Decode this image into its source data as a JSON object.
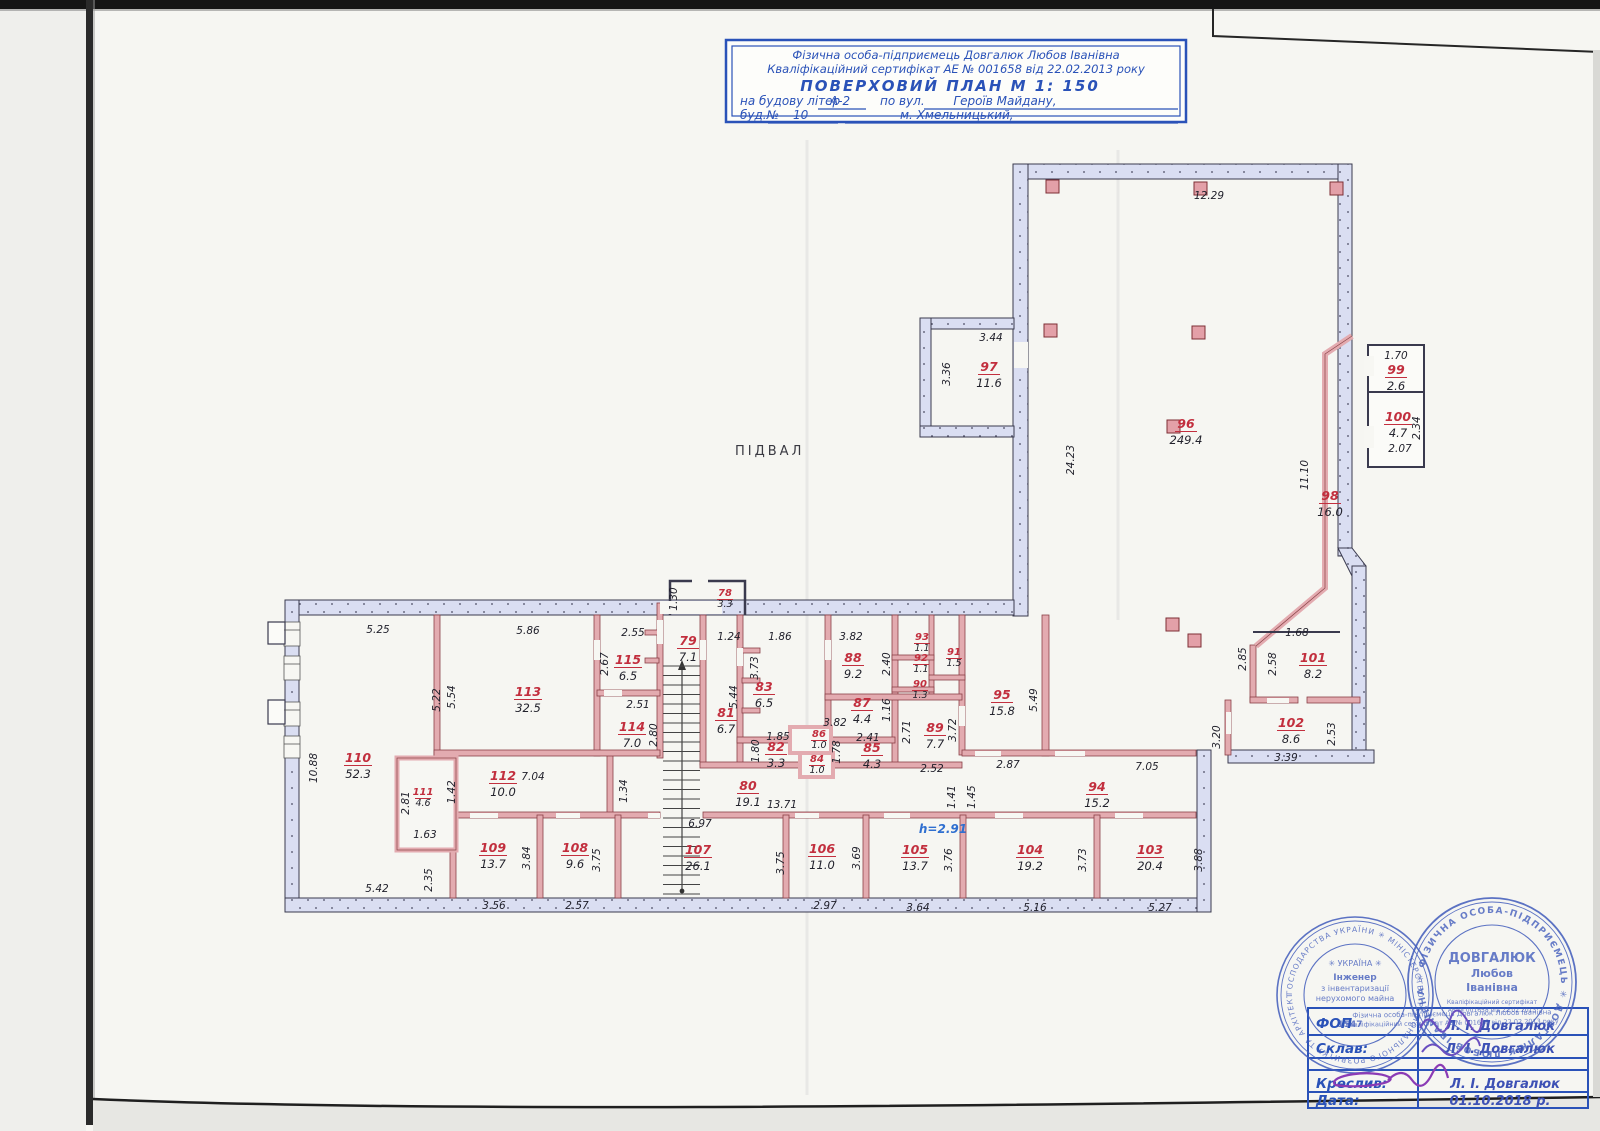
{
  "title_block": {
    "line1": "Фізична особа-підприємець Довгалюк Любов Іванівна",
    "line2": "Кваліфікаційний сертифікат АЕ № 001658 від 22.02.2013 року",
    "line3": "ПОВЕРХОВИЙ  ПЛАН      М 1: 150",
    "line4_prefix": "на будову літер",
    "line4_litera": "А-2",
    "line4_via": "по вул.",
    "line4_street": "Героїв Майдану,",
    "line5_prefix": "буд.№",
    "line5_number": "10",
    "line5_city": "м. Хмельницький,"
  },
  "plan": {
    "floor_label": "ПІДВАЛ",
    "height_note": "h=2.91",
    "rooms": [
      {
        "n": "78",
        "a": "3.3",
        "x": 725,
        "y": 596,
        "s": 1
      },
      {
        "n": "79",
        "a": "7.1",
        "x": 688,
        "y": 645
      },
      {
        "n": "80",
        "a": "19.1",
        "x": 748,
        "y": 790
      },
      {
        "n": "81",
        "a": "6.7",
        "x": 726,
        "y": 717
      },
      {
        "n": "82",
        "a": "3.3",
        "x": 776,
        "y": 751
      },
      {
        "n": "83",
        "a": "6.5",
        "x": 764,
        "y": 691
      },
      {
        "n": "84",
        "a": "1.0",
        "x": 817,
        "y": 762,
        "s": 1
      },
      {
        "n": "85",
        "a": "4.3",
        "x": 872,
        "y": 752
      },
      {
        "n": "86",
        "a": "1.0",
        "x": 819,
        "y": 737,
        "s": 1
      },
      {
        "n": "87",
        "a": "4.4",
        "x": 862,
        "y": 707
      },
      {
        "n": "88",
        "a": "9.2",
        "x": 853,
        "y": 662
      },
      {
        "n": "89",
        "a": "7.7",
        "x": 935,
        "y": 732
      },
      {
        "n": "90",
        "a": "1.3",
        "x": 920,
        "y": 687,
        "s": 1
      },
      {
        "n": "91",
        "a": "1.5",
        "x": 954,
        "y": 655,
        "s": 1
      },
      {
        "n": "92",
        "a": "1.1",
        "x": 921,
        "y": 661,
        "s": 1
      },
      {
        "n": "93",
        "a": "1.1",
        "x": 922,
        "y": 640,
        "s": 1
      },
      {
        "n": "94",
        "a": "15.2",
        "x": 1097,
        "y": 791
      },
      {
        "n": "95",
        "a": "15.8",
        "x": 1002,
        "y": 699
      },
      {
        "n": "96",
        "a": "249.4",
        "x": 1186,
        "y": 428
      },
      {
        "n": "97",
        "a": "11.6",
        "x": 989,
        "y": 371
      },
      {
        "n": "98",
        "a": "16.0",
        "x": 1330,
        "y": 500
      },
      {
        "n": "99",
        "a": "2.6",
        "x": 1396,
        "y": 374
      },
      {
        "n": "100",
        "a": "4.7",
        "x": 1398,
        "y": 421
      },
      {
        "n": "101",
        "a": "8.2",
        "x": 1313,
        "y": 662
      },
      {
        "n": "102",
        "a": "8.6",
        "x": 1291,
        "y": 727
      },
      {
        "n": "103",
        "a": "20.4",
        "x": 1150,
        "y": 854
      },
      {
        "n": "104",
        "a": "19.2",
        "x": 1030,
        "y": 854
      },
      {
        "n": "105",
        "a": "13.7",
        "x": 915,
        "y": 854
      },
      {
        "n": "106",
        "a": "11.0",
        "x": 822,
        "y": 853
      },
      {
        "n": "107",
        "a": "26.1",
        "x": 698,
        "y": 854
      },
      {
        "n": "108",
        "a": "9.6",
        "x": 575,
        "y": 852
      },
      {
        "n": "109",
        "a": "13.7",
        "x": 493,
        "y": 852
      },
      {
        "n": "110",
        "a": "52.3",
        "x": 358,
        "y": 762
      },
      {
        "n": "111",
        "a": "4.6",
        "x": 423,
        "y": 795,
        "s": 1
      },
      {
        "n": "112",
        "a": "10.0",
        "x": 503,
        "y": 780
      },
      {
        "n": "113",
        "a": "32.5",
        "x": 528,
        "y": 696
      },
      {
        "n": "114",
        "a": "7.0",
        "x": 632,
        "y": 731
      },
      {
        "n": "115",
        "a": "6.5",
        "x": 628,
        "y": 664
      }
    ],
    "dims": [
      {
        "t": "12.29",
        "x": 1209,
        "y": 199
      },
      {
        "t": "3.44",
        "x": 991,
        "y": 341
      },
      {
        "t": "3.36",
        "x": 950,
        "y": 374,
        "r": 1
      },
      {
        "t": "24.23",
        "x": 1074,
        "y": 460,
        "r": 1
      },
      {
        "t": "11.10",
        "x": 1308,
        "y": 475,
        "r": 1
      },
      {
        "t": "1.70",
        "x": 1396,
        "y": 359
      },
      {
        "t": "2.34",
        "x": 1420,
        "y": 428,
        "r": 1
      },
      {
        "t": "2.07",
        "x": 1400,
        "y": 452
      },
      {
        "t": "1.68",
        "x": 1297,
        "y": 636
      },
      {
        "t": "2.85",
        "x": 1246,
        "y": 659,
        "r": 1
      },
      {
        "t": "2.58",
        "x": 1276,
        "y": 664,
        "r": 1
      },
      {
        "t": "2.53",
        "x": 1335,
        "y": 734,
        "r": 1
      },
      {
        "t": "3.20",
        "x": 1220,
        "y": 737,
        "r": 1
      },
      {
        "t": "3.39",
        "x": 1286,
        "y": 761
      },
      {
        "t": "7.05",
        "x": 1147,
        "y": 770
      },
      {
        "t": "1.41",
        "x": 955,
        "y": 797,
        "r": 1
      },
      {
        "t": "1.45",
        "x": 975,
        "y": 797,
        "r": 1
      },
      {
        "t": "2.87",
        "x": 1008,
        "y": 768
      },
      {
        "t": "5.49",
        "x": 1037,
        "y": 700,
        "r": 1
      },
      {
        "t": "3.72",
        "x": 956,
        "y": 730,
        "r": 1
      },
      {
        "t": "2.71",
        "x": 910,
        "y": 732,
        "r": 1
      },
      {
        "t": "2.52",
        "x": 932,
        "y": 772
      },
      {
        "t": "2.40",
        "x": 890,
        "y": 664,
        "r": 1
      },
      {
        "t": "1.16",
        "x": 890,
        "y": 710,
        "r": 1
      },
      {
        "t": "3.82",
        "x": 851,
        "y": 640
      },
      {
        "t": "3.82",
        "x": 835,
        "y": 726
      },
      {
        "t": "2.41",
        "x": 868,
        "y": 741
      },
      {
        "t": "1.78",
        "x": 840,
        "y": 752,
        "r": 1
      },
      {
        "t": "1.85",
        "x": 778,
        "y": 740
      },
      {
        "t": "1.80",
        "x": 759,
        "y": 751,
        "r": 1
      },
      {
        "t": "1.86",
        "x": 780,
        "y": 640
      },
      {
        "t": "3.73",
        "x": 758,
        "y": 668,
        "r": 1
      },
      {
        "t": "1.24",
        "x": 729,
        "y": 640
      },
      {
        "t": "5.44",
        "x": 737,
        "y": 697,
        "r": 1
      },
      {
        "t": "1.30",
        "x": 677,
        "y": 599,
        "r": 1
      },
      {
        "t": "2.55",
        "x": 633,
        "y": 636
      },
      {
        "t": "2.67",
        "x": 608,
        "y": 664,
        "r": 1
      },
      {
        "t": "2.51",
        "x": 638,
        "y": 708
      },
      {
        "t": "2.80",
        "x": 657,
        "y": 735,
        "r": 1
      },
      {
        "t": "5.86",
        "x": 528,
        "y": 634
      },
      {
        "t": "5.22",
        "x": 440,
        "y": 700,
        "r": 1
      },
      {
        "t": "5.54",
        "x": 455,
        "y": 697,
        "r": 1
      },
      {
        "t": "5.25",
        "x": 378,
        "y": 633
      },
      {
        "t": "10.88",
        "x": 317,
        "y": 768,
        "r": 1
      },
      {
        "t": "2.81",
        "x": 409,
        "y": 803,
        "r": 1
      },
      {
        "t": "1.42",
        "x": 455,
        "y": 792,
        "r": 1
      },
      {
        "t": "1.63",
        "x": 425,
        "y": 838
      },
      {
        "t": "2.35",
        "x": 432,
        "y": 880,
        "r": 1
      },
      {
        "t": "5.42",
        "x": 377,
        "y": 892
      },
      {
        "t": "7.04",
        "x": 533,
        "y": 780
      },
      {
        "t": "1.34",
        "x": 627,
        "y": 791,
        "r": 1
      },
      {
        "t": "13.71",
        "x": 782,
        "y": 808
      },
      {
        "t": "6.97",
        "x": 700,
        "y": 827
      },
      {
        "t": "3.84",
        "x": 530,
        "y": 858,
        "r": 1
      },
      {
        "t": "3.56",
        "x": 494,
        "y": 909
      },
      {
        "t": "3.75",
        "x": 600,
        "y": 860,
        "r": 1
      },
      {
        "t": "2.57",
        "x": 577,
        "y": 909
      },
      {
        "t": "3.75",
        "x": 784,
        "y": 863,
        "r": 1
      },
      {
        "t": "2.97",
        "x": 825,
        "y": 909
      },
      {
        "t": "3.69",
        "x": 860,
        "y": 858,
        "r": 1
      },
      {
        "t": "3.64",
        "x": 918,
        "y": 911
      },
      {
        "t": "3.76",
        "x": 952,
        "y": 860,
        "r": 1
      },
      {
        "t": "5.16",
        "x": 1035,
        "y": 911
      },
      {
        "t": "3.73",
        "x": 1086,
        "y": 860,
        "r": 1
      },
      {
        "t": "5.27",
        "x": 1160,
        "y": 911
      },
      {
        "t": "3.88",
        "x": 1202,
        "y": 860,
        "r": 1
      }
    ]
  },
  "stamps": {
    "left": {
      "ring": "ГОСПОДАРСТВА УКРАЇНИ ✳ МІНІСТЕРСТВО РЕГІОНАЛЬНОГО РОЗВИТКУ ТА АРХІТЕКТУРНО-БУДІВЕЛЬНОЇ ПОЛІТИКИ ✳",
      "c1": "✳ УКРАЇНА ✳",
      "c2": "Інженер",
      "c3": "з інвентаризації",
      "c4": "нерухомого майна",
      "num": "1547"
    },
    "right": {
      "ring": "✳ ФІЗИЧНА ОСОБА-ПІДПРИЄМЕЦЬ ✳ ДОВГАЛЮК ЛЮБОВ ІВАНІВНА ",
      "c1": "ДОВГАЛЮК",
      "c2": "Любов",
      "c3": "Іванівна",
      "c4": "Кваліфікаційний сертифікат",
      "c5": "АЕ № 001658 від 22.02.2013"
    },
    "overlay1": "Фізична особа-підприємець Довгалюк Любов Іванівна",
    "overlay2": "Кваліфікаційний сертифікат АЕ № 001658 від 22.02.2013 року"
  },
  "sign_table": {
    "rows": [
      {
        "label": "ФОП",
        "value": "Л. І. Довгалюк"
      },
      {
        "label": "Склав:",
        "value": "Л. І. Довгалюк"
      },
      {
        "label": "",
        "value": ""
      },
      {
        "label": "Креслив:",
        "value": "Л. І. Довгалюк"
      },
      {
        "label": "Дата:",
        "value": "01.10.2018 р."
      }
    ]
  }
}
